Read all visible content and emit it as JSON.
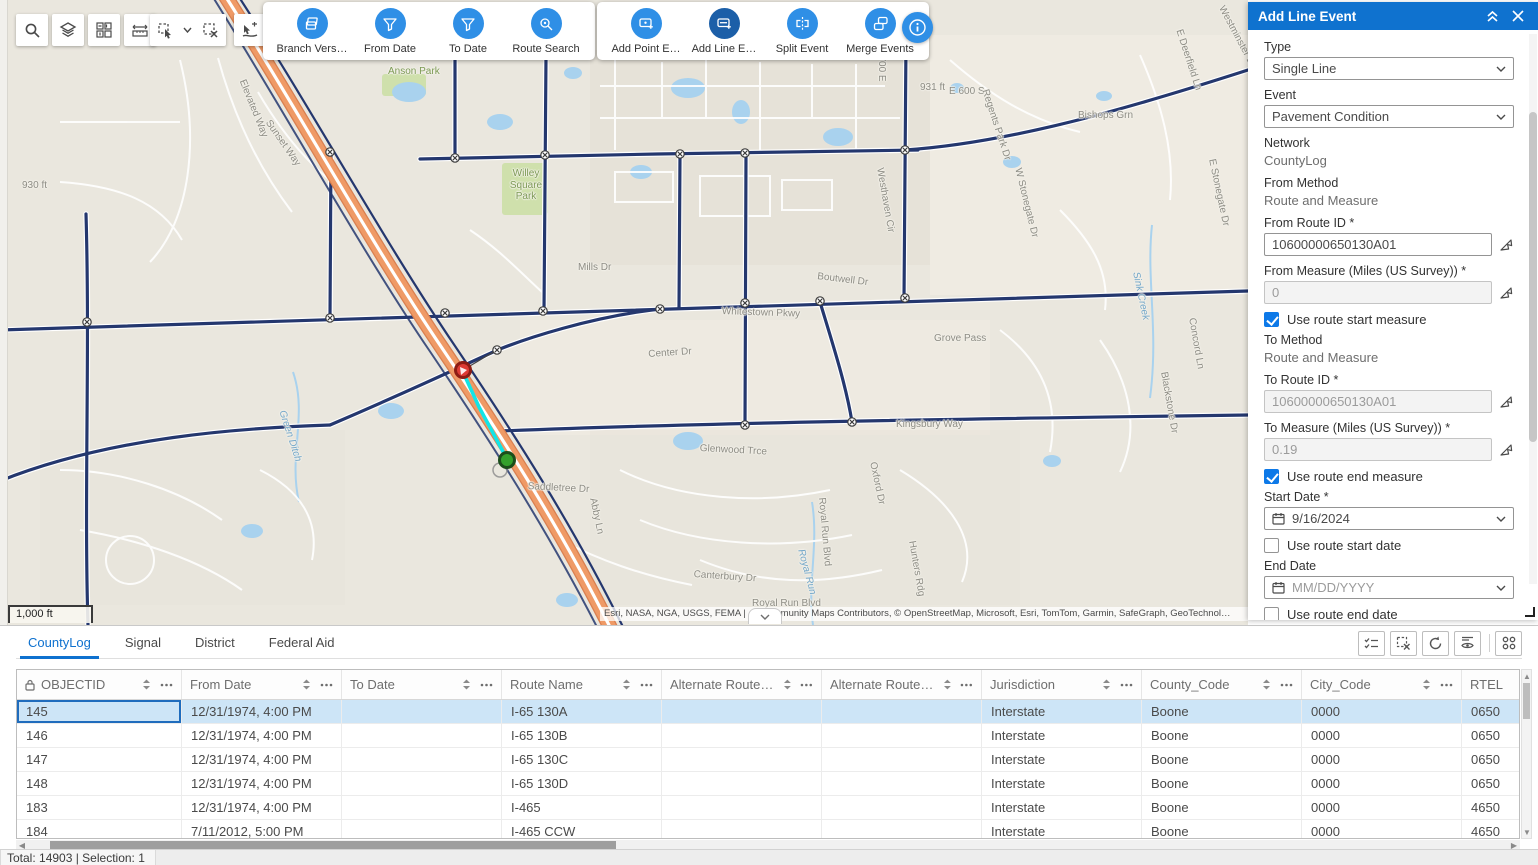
{
  "toolbars": {
    "group1": [
      {
        "label": "Branch Vers…",
        "icon": "branch-version-icon"
      },
      {
        "label": "From Date",
        "icon": "from-date-filter-icon"
      },
      {
        "label": "To Date",
        "icon": "to-date-filter-icon"
      },
      {
        "label": "Route Search",
        "icon": "route-search-icon"
      }
    ],
    "group2": [
      {
        "label": "Add Point E…",
        "icon": "add-point-event-icon",
        "active": false
      },
      {
        "label": "Add Line E…",
        "icon": "add-line-event-icon",
        "active": true
      },
      {
        "label": "Split Event",
        "icon": "split-event-icon",
        "active": false
      },
      {
        "label": "Merge Events",
        "icon": "merge-events-icon",
        "active": false
      }
    ],
    "map_tools": [
      "search",
      "layers",
      "basemap",
      "measure",
      "select",
      "clear-selection",
      "select-route"
    ]
  },
  "map": {
    "scale_bar": "1,000 ft",
    "attribution": "Esri, NASA, NGA, USGS, FEMA | … Community Maps Contributors, © OpenStreetMap, Microsoft, Esri, TomTom, Garmin, SafeGraph, GeoTechnol…",
    "selection_colors": {
      "route": "#12e4e6",
      "start_marker": "#dd3b34",
      "end_marker": "#33a02c"
    },
    "labels": [
      {
        "t": "Elevated Way",
        "x": 247,
        "y": 78,
        "r": 68
      },
      {
        "t": "Sunset Way",
        "x": 272,
        "y": 118,
        "r": 55
      },
      {
        "t": "Anson Park",
        "x": 388,
        "y": 66,
        "r": 0,
        "c": "g"
      },
      {
        "t": "Willey Square Park",
        "x": 500,
        "y": 168,
        "r": 0,
        "c": "g",
        "w": 52
      },
      {
        "t": "Mills Dr",
        "x": 578,
        "y": 262,
        "r": 0
      },
      {
        "t": "Center Dr",
        "x": 648,
        "y": 349,
        "r": -4
      },
      {
        "t": "Boutwell Dr",
        "x": 818,
        "y": 271,
        "r": 7
      },
      {
        "t": "Whitestown Pkwy",
        "x": 722,
        "y": 306,
        "r": 2
      },
      {
        "t": "Grove Pass",
        "x": 934,
        "y": 333,
        "r": 0
      },
      {
        "t": "Kingsbury Way",
        "x": 896,
        "y": 419,
        "r": 0
      },
      {
        "t": "Glenwood Trce",
        "x": 700,
        "y": 443,
        "r": 3
      },
      {
        "t": "Saddletree Dr",
        "x": 528,
        "y": 481,
        "r": 3
      },
      {
        "t": "Abby Ln",
        "x": 598,
        "y": 497,
        "r": 78
      },
      {
        "t": "Canterbury Dr",
        "x": 694,
        "y": 569,
        "r": 4
      },
      {
        "t": "Royal Run Blvd",
        "x": 752,
        "y": 598,
        "r": 0
      },
      {
        "t": "Royal Run Blvd",
        "x": 827,
        "y": 497,
        "r": 85
      },
      {
        "t": "Oxford Dr",
        "x": 878,
        "y": 461,
        "r": 78
      },
      {
        "t": "Hunters Rdg",
        "x": 917,
        "y": 540,
        "r": 80
      },
      {
        "t": "Royal Run",
        "x": 806,
        "y": 548,
        "r": 75,
        "c": "b"
      },
      {
        "t": "931 ft",
        "x": 920,
        "y": 82,
        "r": 0
      },
      {
        "t": "E 600 S",
        "x": 949,
        "y": 86,
        "r": 0
      },
      {
        "t": "930 ft",
        "x": 22,
        "y": 180,
        "r": 0
      },
      {
        "t": "S 700 E",
        "x": 887,
        "y": 46,
        "r": 90
      },
      {
        "t": "Regents Park Dr",
        "x": 990,
        "y": 88,
        "r": 72
      },
      {
        "t": "Bishops Grn",
        "x": 1078,
        "y": 110,
        "r": 0
      },
      {
        "t": "E Deerfield Ln",
        "x": 1184,
        "y": 28,
        "r": 72
      },
      {
        "t": "Westminster Dr",
        "x": 1226,
        "y": 4,
        "r": 62
      },
      {
        "t": "W Stonegate Dr",
        "x": 1023,
        "y": 167,
        "r": 76
      },
      {
        "t": "Westhaven Cir",
        "x": 885,
        "y": 167,
        "r": 80
      },
      {
        "t": "E Stonegate Dr",
        "x": 1217,
        "y": 158,
        "r": 78
      },
      {
        "t": "Concord Ln",
        "x": 1197,
        "y": 317,
        "r": 80
      },
      {
        "t": "Blackstone Dr",
        "x": 1169,
        "y": 371,
        "r": 80
      },
      {
        "t": "Sink Creek",
        "x": 1141,
        "y": 271,
        "r": 78,
        "c": "b"
      },
      {
        "t": "Green Ditch",
        "x": 287,
        "y": 409,
        "r": 72,
        "c": "b"
      }
    ]
  },
  "panel": {
    "title": "Add Line Event",
    "type_label": "Type",
    "type_value": "Single Line",
    "event_label": "Event",
    "event_value": "Pavement Condition",
    "network_label": "Network",
    "network_value": "CountyLog",
    "from_method_label": "From Method",
    "from_method_value": "Route and Measure",
    "from_route_label": "From Route ID *",
    "from_route_value": "10600000650130A01",
    "from_measure_label": "From Measure (Miles (US Survey)) *",
    "from_measure_value": "0",
    "cb_start_measure": "Use route start measure",
    "to_method_label": "To Method",
    "to_method_value": "Route and Measure",
    "to_route_label": "To Route ID *",
    "to_route_value": "10600000650130A01",
    "to_measure_label": "To Measure (Miles (US Survey)) *",
    "to_measure_value": "0.19",
    "cb_end_measure": "Use route end measure",
    "start_date_label": "Start Date *",
    "start_date_value": "9/16/2024",
    "cb_start_date": "Use route start date",
    "end_date_label": "End Date",
    "end_date_placeholder": "MM/DD/YYYY",
    "cb_end_date": "Use route end date",
    "reset_label": "Reset",
    "next_label": "Next"
  },
  "table": {
    "tabs": [
      {
        "label": "CountyLog",
        "active": true
      },
      {
        "label": "Signal",
        "active": false
      },
      {
        "label": "District",
        "active": false
      },
      {
        "label": "Federal Aid",
        "active": false
      }
    ],
    "columns": [
      {
        "label": "OBJECTID",
        "locked": true
      },
      {
        "label": "From Date"
      },
      {
        "label": "To Date"
      },
      {
        "label": "Route Name"
      },
      {
        "label": "Alternate Route …"
      },
      {
        "label": "Alternate Route …"
      },
      {
        "label": "Jurisdiction"
      },
      {
        "label": "County_Code"
      },
      {
        "label": "City_Code"
      },
      {
        "label": "RTEL"
      }
    ],
    "rows": [
      {
        "selected": true,
        "cells": [
          "145",
          "12/31/1974, 4:00 PM",
          "",
          "I-65 130A",
          "",
          "",
          "Interstate",
          "Boone",
          "0000",
          "0650"
        ]
      },
      {
        "selected": false,
        "cells": [
          "146",
          "12/31/1974, 4:00 PM",
          "",
          "I-65 130B",
          "",
          "",
          "Interstate",
          "Boone",
          "0000",
          "0650"
        ]
      },
      {
        "selected": false,
        "cells": [
          "147",
          "12/31/1974, 4:00 PM",
          "",
          "I-65 130C",
          "",
          "",
          "Interstate",
          "Boone",
          "0000",
          "0650"
        ]
      },
      {
        "selected": false,
        "cells": [
          "148",
          "12/31/1974, 4:00 PM",
          "",
          "I-65 130D",
          "",
          "",
          "Interstate",
          "Boone",
          "0000",
          "0650"
        ]
      },
      {
        "selected": false,
        "cells": [
          "183",
          "12/31/1974, 4:00 PM",
          "",
          "I-465",
          "",
          "",
          "Interstate",
          "Boone",
          "0000",
          "4650"
        ]
      },
      {
        "selected": false,
        "cells": [
          "184",
          "7/11/2012, 5:00 PM",
          "",
          "I-465 CCW",
          "",
          "",
          "Interstate",
          "Boone",
          "0000",
          "4650"
        ]
      }
    ],
    "status": "Total: 14903 | Selection: 1"
  },
  "colors": {
    "panel_header_blue": "#0f72cf",
    "toolbar_circle_blue": "#2f8fe6",
    "toolbar_circle_active": "#1c5fa8",
    "accent_blue": "#0d79e8",
    "selected_row": "#cde5f7",
    "selection_cyan": "#12e4e6",
    "highway_orange": "#ef9a66",
    "road_navy": "#24376e"
  }
}
